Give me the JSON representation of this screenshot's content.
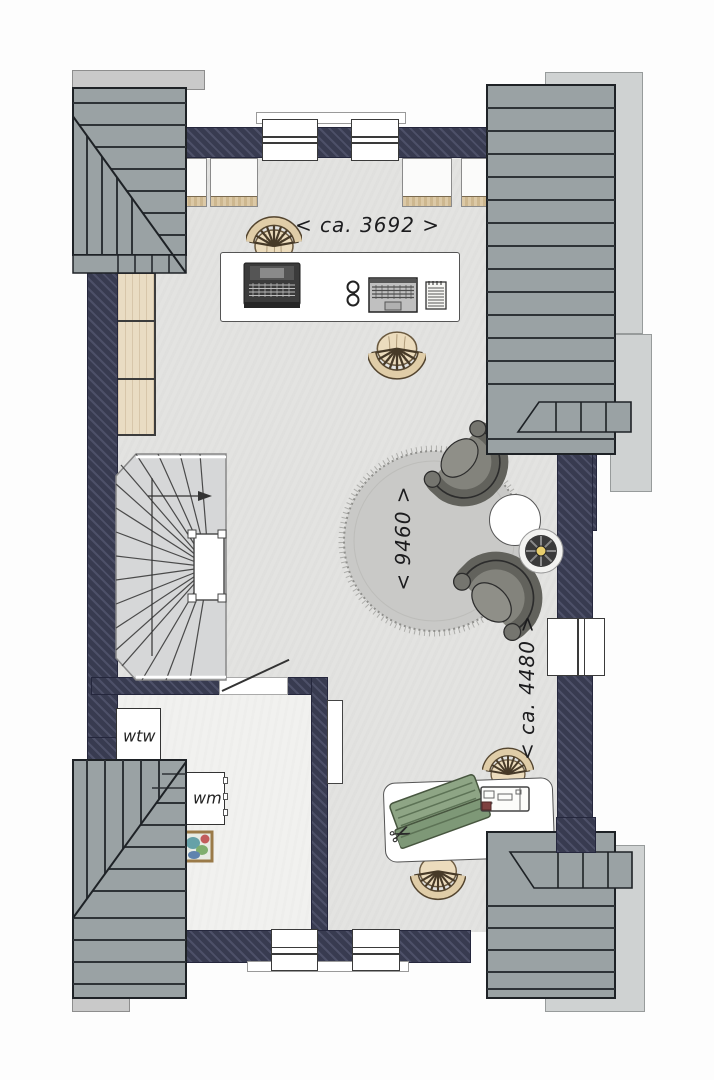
{
  "plan": {
    "dim_top": "< ca. 3692 >",
    "dim_rug": "< 9460 >",
    "dim_right": "< ca. 4480 >",
    "label_wtw": "wtw",
    "label_wm": "wm"
  },
  "icons": {
    "scissors": "✂"
  },
  "colors": {
    "wall": "#3a3d52",
    "roof": "#9aa2a4",
    "roof_line": "#2e3337",
    "neighbor_panel": "#cfd2d2",
    "floor": "#e3e3e1",
    "laundry_floor": "#f1f1ef",
    "wood": "#e9dcc3",
    "rug": "#c9c9c7",
    "armchair": "#6e6e68",
    "fabric": "#8ea585",
    "fan_center": "#e9cf6d"
  }
}
